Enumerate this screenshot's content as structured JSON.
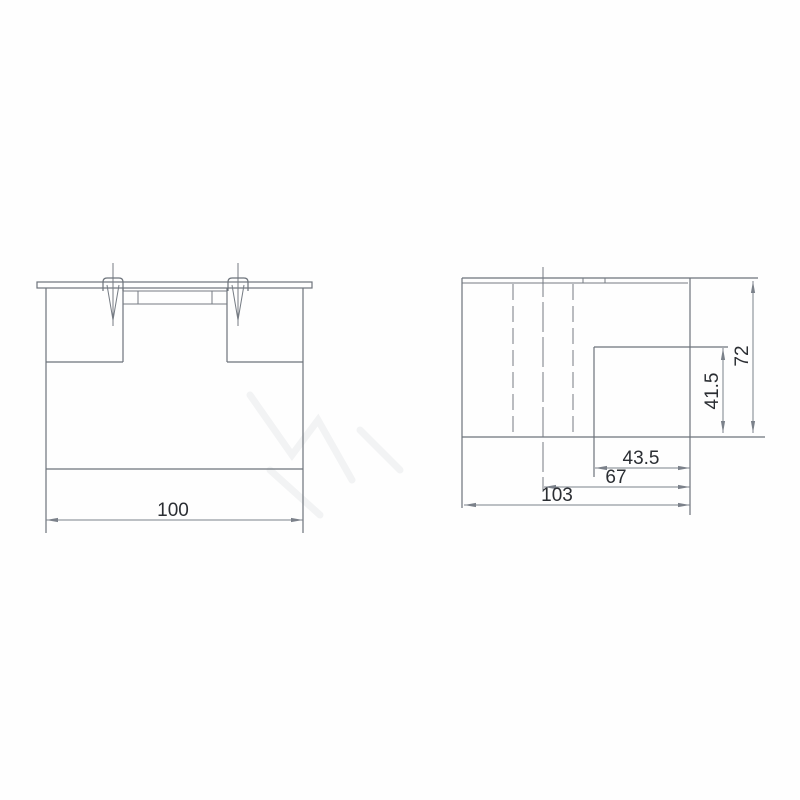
{
  "front_view": {
    "dim_width": "100"
  },
  "side_view": {
    "dim_recess_width": "43.5",
    "dim_center_to_edge": "67",
    "dim_overall_width": "103",
    "dim_recess_height": "41.5",
    "dim_overall_height": "72"
  },
  "colors": {
    "background": "#fefefe",
    "outline_line": "#6d737b",
    "dimension_line": "#7b818a",
    "label_text": "#2b2e33"
  }
}
